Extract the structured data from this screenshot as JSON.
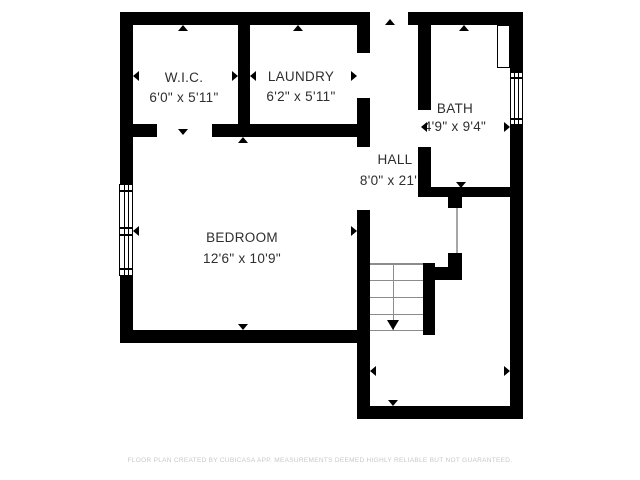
{
  "floor_plan": {
    "rooms": [
      {
        "name": "W.I.C.",
        "dims": "6'0\" x 5'11\""
      },
      {
        "name": "LAUNDRY",
        "dims": "6'2\" x 5'11\""
      },
      {
        "name": "BATH",
        "dims": "4'9\" x 9'4\""
      },
      {
        "name": "HALL",
        "dims": "8'0\" x 21'1\""
      },
      {
        "name": "BEDROOM",
        "dims": "12'6\" x 10'9\""
      }
    ],
    "footer_disclaimer": "FLOOR PLAN CREATED BY CUBICASA APP. MEASUREMENTS DEEMED HIGHLY RELIABLE BUT NOT GUARANTEED.",
    "colors": {
      "wall": "#000000",
      "background": "#ffffff",
      "stair_lines": "#8c8c8c",
      "room_text": "#2e2e2e",
      "footer_text": "#c8c8c8"
    }
  }
}
